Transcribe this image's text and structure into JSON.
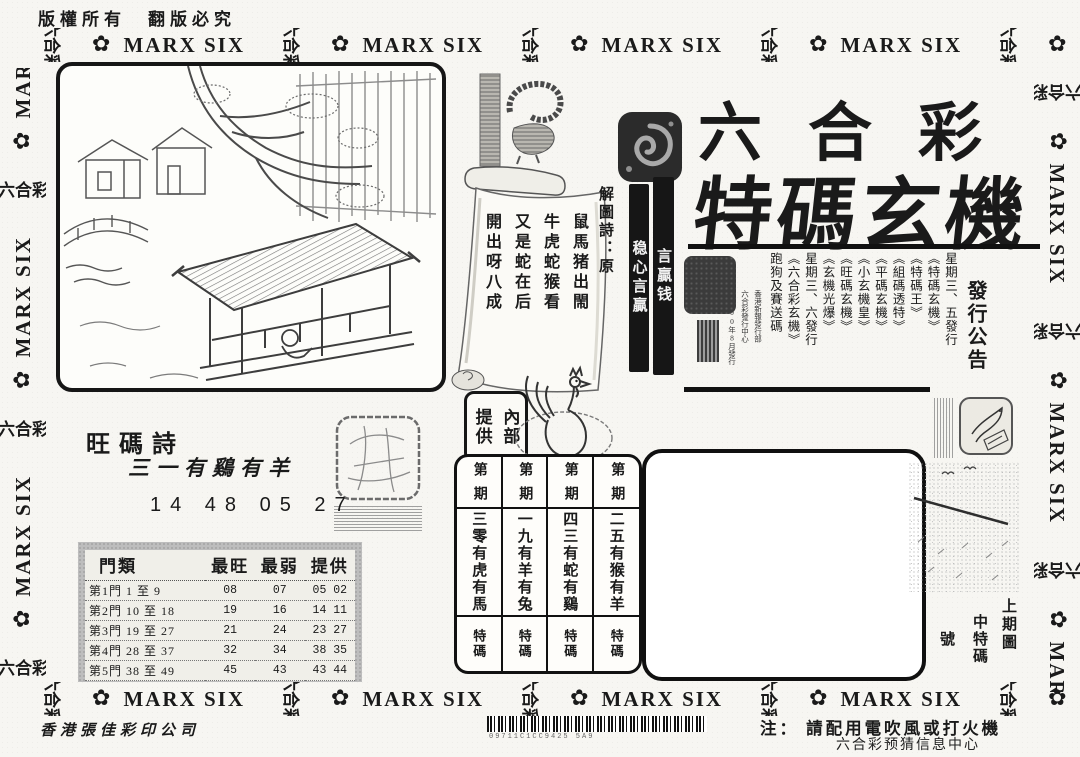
{
  "colors": {
    "ink": "#1a1a1a",
    "paper": "#f7f6f2",
    "panel_gray": "#bdbdbd",
    "bar_black": "#161616"
  },
  "copyright": "版權所有　翻版必究",
  "border": {
    "cjk": "六合彩",
    "flower": "✿",
    "latin": "MARX SIX"
  },
  "title": {
    "line1": "六合彩",
    "line2": "特碼玄機"
  },
  "scroll": {
    "bar_left": "稳心言贏",
    "bar_right": "言贏钱",
    "poem_title": "解圖詩：原",
    "poem_lines": [
      "鼠馬猪出閙",
      "牛虎蛇猴看",
      "又是蛇在后",
      "開出呀八成"
    ]
  },
  "supply_box": {
    "right": "內部",
    "left": "提供"
  },
  "announcement": {
    "heading": "發行公告",
    "items": [
      "星期三、五發行",
      "《特碼玄機》",
      "《特碼王》",
      "《組碼透特》",
      "《平碼玄機》",
      "《小玄機皇》",
      "《旺碼玄機》",
      "《玄機光爆》",
      "星期三、六發行",
      "《六合彩玄機》",
      "跑狗及賽送碼"
    ],
    "publisher": [
      "香港新報發行部",
      "六合彩發行中心",
      "2000年8月發行"
    ]
  },
  "wangma": {
    "heading": "旺碼詩",
    "verse": "三一有鷄有羊",
    "numbers": "14 48 05 27"
  },
  "stats": {
    "headers": [
      "門類",
      "最旺",
      "最弱",
      "提供"
    ],
    "rows": [
      [
        "第1門 1 至 9",
        "08",
        "07",
        "05 02"
      ],
      [
        "第2門 10 至 18",
        "19",
        "16",
        "14 11"
      ],
      [
        "第3門 19 至 27",
        "21",
        "24",
        "23 27"
      ],
      [
        "第4門 28 至 37",
        "32",
        "34",
        "38 35"
      ],
      [
        "第5門 38 至 49",
        "45",
        "43",
        "43 44"
      ]
    ]
  },
  "periods": {
    "header_top": "第",
    "header_bottom": "期",
    "columns": [
      {
        "phrase": "三零有虎有馬",
        "tag": "特碼"
      },
      {
        "phrase": "一九有羊有兔",
        "tag": "特碼"
      },
      {
        "phrase": "四三有蛇有鷄",
        "tag": "特碼"
      },
      {
        "phrase": "二五有猴有羊",
        "tag": "特碼"
      }
    ]
  },
  "last_issue": {
    "caption": "上期圖",
    "result_prefix": "中特碼",
    "result_suffix": "號"
  },
  "footer": {
    "printer": "香港張佳彩印公司",
    "barcode_text": "09711C1CC9425 5A9",
    "note": "注： 請配用電吹風或打火機",
    "info_center": "六合彩预猜信息中心"
  }
}
